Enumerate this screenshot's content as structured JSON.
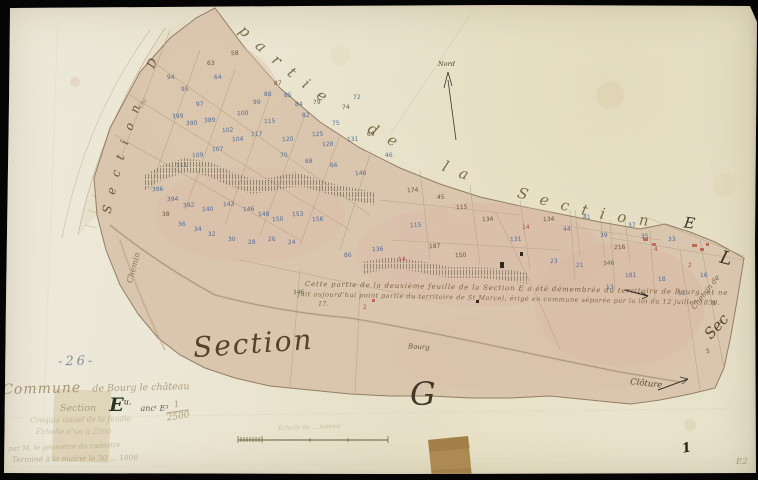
{
  "document": {
    "page_number": "-26-",
    "commune_word": "Commune",
    "commune_rest": "de Bourg le château",
    "section_word": "Section",
    "section_letter": "E",
    "section_sup": "u.",
    "section_rest": "ancᵗ E³",
    "faded_lines": [
      "Croquis visuel de la feuille",
      "Échelle d'un à 2500",
      "par M. le géomètre du cadastre",
      "Terminé à la mairie le 30 ... 1808"
    ],
    "scale_fraction": {
      "numerator": "1",
      "denominator": "2500"
    },
    "scalebar_label": "Échelle de ... mètres",
    "corner_ink_mark": "1",
    "corner_pencil_mark": "E2"
  },
  "map": {
    "section_script": "Section",
    "letter_g": "G",
    "top_phrase": "partie de la Section",
    "strip_phrase": "Section D",
    "strip_sub": "Ou",
    "letter_e_right": "E",
    "letter_l_right": "L",
    "left_road_label": "Chemin",
    "right_road_label": "Chemin de",
    "right_sec_label": "Sec",
    "bourg_label": "Bourg",
    "cloture_label": "Clôture",
    "north_label": "Nord",
    "annotation": {
      "line1": "Cette partie de la deuxième feuille de la Section E a été démembrée du territoire de Bourg, et ne",
      "line2": "fait aujourd'hui point partie du territoire de St Marcel, érigé en commune séparée par la loi du 12 juillet 1850.",
      "line3": "17."
    }
  },
  "colors": {
    "blue": "#3c5f8f",
    "ink": "#57452c",
    "red": "#a83c30",
    "green": "#4a6a3a"
  },
  "parcel_numbers": [
    [
      167,
      74,
      "94",
      "b"
    ],
    [
      181,
      86,
      "95",
      "b"
    ],
    [
      207,
      60,
      "63",
      "i"
    ],
    [
      214,
      74,
      "64",
      "b"
    ],
    [
      231,
      50,
      "58",
      "i"
    ],
    [
      196,
      101,
      "97",
      "b"
    ],
    [
      172,
      113,
      "399",
      "b"
    ],
    [
      186,
      120,
      "390",
      "b"
    ],
    [
      204,
      117,
      "389",
      "b"
    ],
    [
      222,
      127,
      "102",
      "b"
    ],
    [
      237,
      110,
      "100",
      "b"
    ],
    [
      253,
      99,
      "99",
      "b"
    ],
    [
      264,
      91,
      "88",
      "b"
    ],
    [
      274,
      80,
      "87",
      "i"
    ],
    [
      284,
      92,
      "85",
      "b"
    ],
    [
      295,
      101,
      "84",
      "b"
    ],
    [
      264,
      118,
      "115",
      "b"
    ],
    [
      302,
      112,
      "82",
      "b"
    ],
    [
      313,
      99,
      "79",
      "i"
    ],
    [
      232,
      136,
      "104",
      "b"
    ],
    [
      212,
      146,
      "107",
      "b"
    ],
    [
      192,
      152,
      "109",
      "b"
    ],
    [
      176,
      162,
      "111",
      "b"
    ],
    [
      251,
      131,
      "117",
      "b"
    ],
    [
      282,
      136,
      "120",
      "b"
    ],
    [
      312,
      131,
      "125",
      "b"
    ],
    [
      332,
      120,
      "75",
      "b"
    ],
    [
      342,
      104,
      "74",
      "i"
    ],
    [
      353,
      94,
      "72",
      "b"
    ],
    [
      322,
      141,
      "128",
      "b"
    ],
    [
      347,
      136,
      "131",
      "b"
    ],
    [
      367,
      131,
      "69",
      "i"
    ],
    [
      152,
      186,
      "396",
      "b"
    ],
    [
      167,
      196,
      "394",
      "b"
    ],
    [
      183,
      202,
      "392",
      "b"
    ],
    [
      202,
      206,
      "140",
      "b"
    ],
    [
      223,
      201,
      "143",
      "b"
    ],
    [
      243,
      206,
      "146",
      "b"
    ],
    [
      258,
      211,
      "148",
      "b"
    ],
    [
      272,
      216,
      "150",
      "b"
    ],
    [
      292,
      211,
      "153",
      "b"
    ],
    [
      312,
      216,
      "156",
      "b"
    ],
    [
      162,
      211,
      "38",
      "i"
    ],
    [
      178,
      221,
      "36",
      "b"
    ],
    [
      194,
      226,
      "34",
      "b"
    ],
    [
      208,
      231,
      "32",
      "b"
    ],
    [
      228,
      236,
      "30",
      "b"
    ],
    [
      248,
      239,
      "28",
      "b"
    ],
    [
      268,
      236,
      "26",
      "b"
    ],
    [
      288,
      239,
      "24",
      "b"
    ],
    [
      385,
      152,
      "46",
      "b"
    ],
    [
      407,
      187,
      "174",
      "i"
    ],
    [
      437,
      194,
      "45",
      "i"
    ],
    [
      456,
      204,
      "115",
      "i"
    ],
    [
      482,
      216,
      "134",
      "i"
    ],
    [
      372,
      246,
      "136",
      "b"
    ],
    [
      344,
      252,
      "86",
      "b"
    ],
    [
      398,
      256,
      "14",
      "r"
    ],
    [
      429,
      243,
      "187",
      "i"
    ],
    [
      522,
      224,
      "14",
      "r"
    ],
    [
      543,
      216,
      "134",
      "i"
    ],
    [
      563,
      226,
      "44",
      "b"
    ],
    [
      583,
      214,
      "41",
      "b"
    ],
    [
      600,
      232,
      "39",
      "b"
    ],
    [
      628,
      222,
      "37",
      "b"
    ],
    [
      641,
      233,
      "35",
      "b"
    ],
    [
      654,
      246,
      "4",
      "r"
    ],
    [
      668,
      236,
      "33",
      "b"
    ],
    [
      614,
      244,
      "216",
      "i"
    ],
    [
      603,
      260,
      "346",
      "g"
    ],
    [
      576,
      262,
      "21",
      "b"
    ],
    [
      550,
      258,
      "23",
      "b"
    ],
    [
      625,
      272,
      "181",
      "b"
    ],
    [
      658,
      276,
      "18",
      "b"
    ],
    [
      688,
      262,
      "2",
      "r"
    ],
    [
      700,
      272,
      "16",
      "b"
    ],
    [
      510,
      236,
      "131",
      "b"
    ],
    [
      410,
      222,
      "115",
      "b"
    ],
    [
      355,
      170,
      "146",
      "b"
    ],
    [
      330,
      162,
      "66",
      "b"
    ],
    [
      305,
      158,
      "68",
      "b"
    ],
    [
      280,
      152,
      "70",
      "b"
    ],
    [
      293,
      289,
      "346",
      "g"
    ],
    [
      363,
      304,
      "2",
      "r"
    ],
    [
      455,
      252,
      "150",
      "i"
    ],
    [
      606,
      284,
      "13",
      "b"
    ],
    [
      678,
      290,
      "11",
      "b"
    ],
    [
      712,
      300,
      "9",
      "i"
    ],
    [
      718,
      320,
      "7",
      "i"
    ],
    [
      706,
      348,
      "5",
      "i"
    ]
  ]
}
